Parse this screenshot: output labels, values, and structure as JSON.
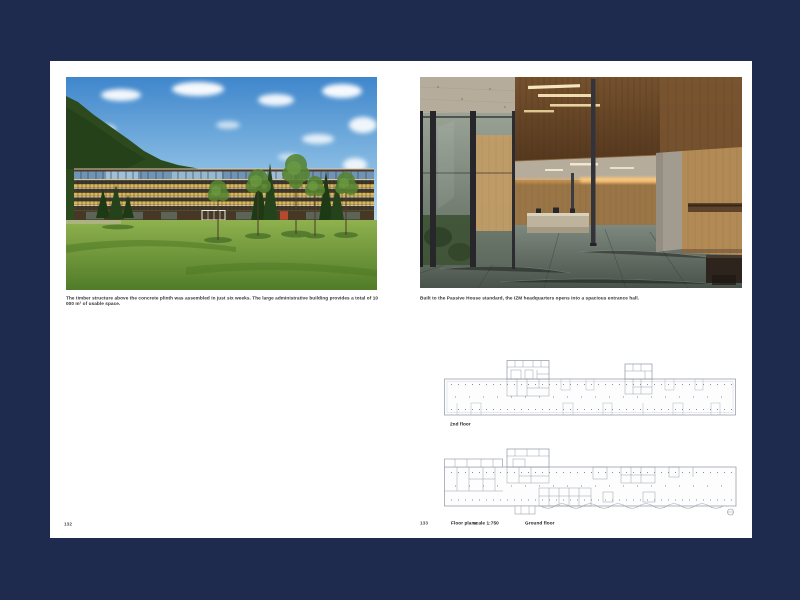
{
  "book": {
    "left_page": {
      "page_number": "132",
      "caption": "The timber structure above the concrete plinth was assembled in just six weeks. The large administrative building provides a total of 10 000 m² of usable space.",
      "photo_subject": "timber administrative building exterior with mountains and meadow"
    },
    "right_page": {
      "page_number": "133",
      "caption": "Built to the Passive House standard, the IZM headquarters opens into a spacious entrance hall.",
      "photo_subject": "wood-lined entrance hall interior",
      "plan_upper_label": "2nd floor",
      "plan_lower_label": "Ground floor",
      "footer_title": "Floor plans",
      "footer_scale": "scale 1:750"
    }
  },
  "colors": {
    "background": "#1f2b4e",
    "page": "#ffffff",
    "caption_text": "#333333"
  }
}
